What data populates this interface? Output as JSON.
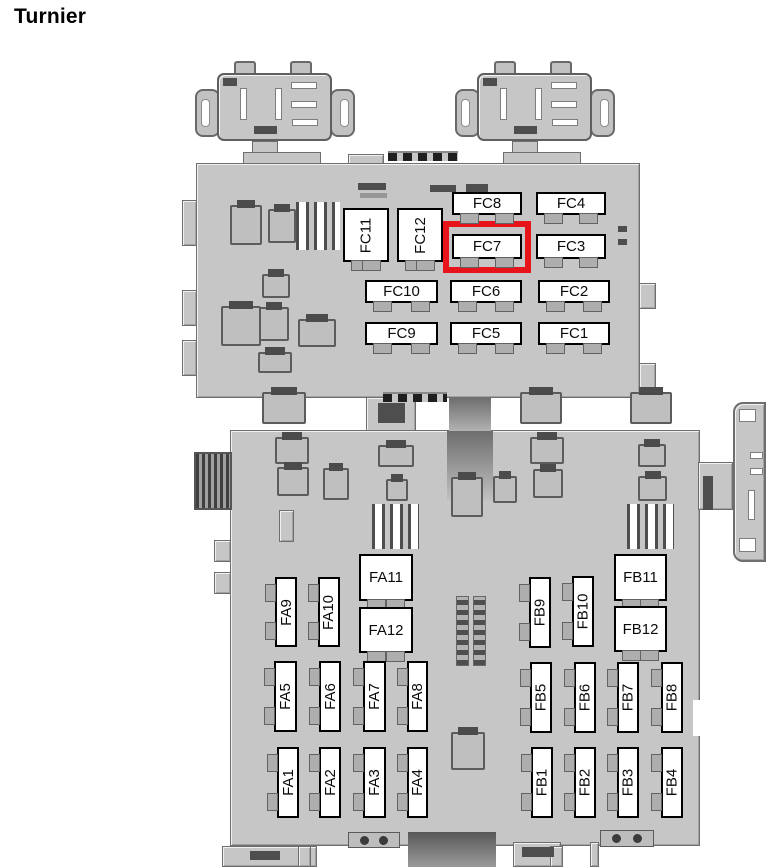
{
  "title": "Turnier",
  "diagram": {
    "description": "Vehicle fuse box diagram (Turnier)",
    "highlight": {
      "fuse": "FC7",
      "color": "#e8141c"
    },
    "body_color": "#c6c6c6",
    "fuses": {
      "fc": {
        "vertical": [
          "FC11",
          "FC12"
        ],
        "grid": [
          "FC8",
          "FC4",
          "FC7",
          "FC3",
          "FC10",
          "FC6",
          "FC2",
          "FC9",
          "FC5",
          "FC1"
        ]
      },
      "fa": {
        "vertical": [
          "FA9",
          "FA10"
        ],
        "squares": [
          "FA11",
          "FA12"
        ],
        "middle_row": [
          "FA5",
          "FA6",
          "FA7",
          "FA8"
        ],
        "bottom_row": [
          "FA1",
          "FA2",
          "FA3",
          "FA4"
        ]
      },
      "fb": {
        "vertical": [
          "FB9",
          "FB10"
        ],
        "squares": [
          "FB11",
          "FB12"
        ],
        "middle_row": [
          "FB5",
          "FB6",
          "FB7",
          "FB8"
        ],
        "bottom_row": [
          "FB1",
          "FB2",
          "FB3",
          "FB4"
        ]
      }
    }
  }
}
